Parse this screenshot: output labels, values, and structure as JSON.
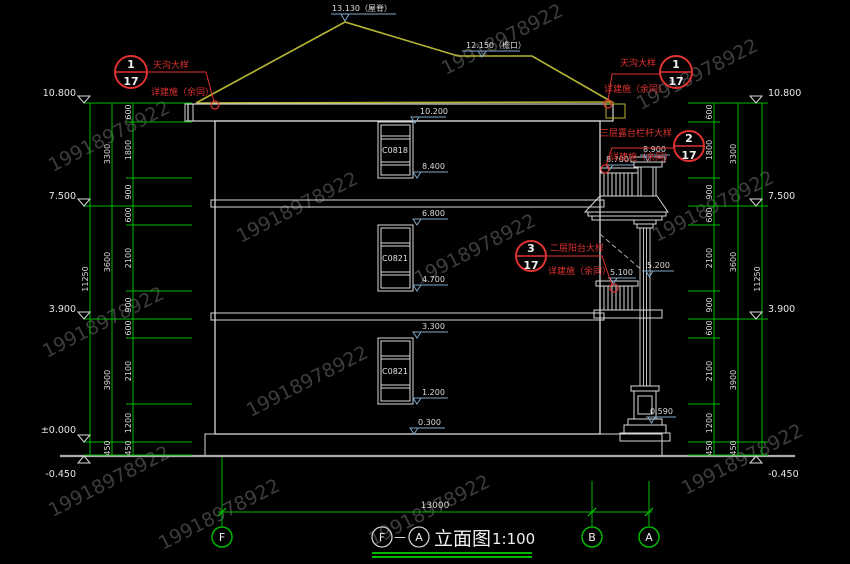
{
  "watermark": "19918978922",
  "title": {
    "axis_from": "F",
    "separator": "—",
    "axis_to": "A",
    "name": "立面图",
    "scale": "1:100"
  },
  "top_marks": {
    "ridge": "13.130（屋脊）",
    "eave": "12.150（檐口）"
  },
  "elevations": {
    "left": [
      "10.800",
      "7.500",
      "3.900",
      "±0.000",
      "-0.450"
    ],
    "right": [
      "10.800",
      "7.500",
      "3.900",
      "-0.450"
    ]
  },
  "dimensions": {
    "inner": [
      "600",
      "1800",
      "900",
      "600",
      "2100",
      "900",
      "600",
      "2100",
      "1200",
      "450"
    ],
    "story": [
      "3300",
      "3600",
      "3900",
      "450"
    ],
    "total": "11250",
    "bottom_total": "13000"
  },
  "windows": [
    {
      "label": "C0818",
      "head": "10.200",
      "sill": "8.400"
    },
    {
      "label": "C0821",
      "head": "6.800",
      "sill": "4.700"
    },
    {
      "label": "C0821",
      "head": "3.300",
      "sill": "1.200"
    }
  ],
  "side_marks": {
    "terrace_railing": "8.700",
    "terrace_canopy": "8.900",
    "balcony_railing": "5.100",
    "balcony_column": "5.200",
    "column_base": "0.590",
    "plinth": "0.300"
  },
  "callouts": [
    {
      "number": "1",
      "sheet": "17",
      "title": "天沟大样",
      "note": "详建施（余同）"
    },
    {
      "number": "1",
      "sheet": "17",
      "title": "天沟大样",
      "note": "详建施（余同）"
    },
    {
      "number": "2",
      "sheet": "17",
      "title": "三层露台栏杆大样",
      "note": "详建施（余同）"
    },
    {
      "number": "3",
      "sheet": "17",
      "title": "二层阳台大样",
      "note": "详建施（余同）"
    }
  ],
  "axes": [
    "F",
    "B",
    "A"
  ],
  "colors": {
    "background": "#000000",
    "dimension_green": "#00b800",
    "drawing_white": "#d8d8d8",
    "roof_yellow": "#b5b533",
    "annotation_red": "#e03232",
    "marker_blue": "#7fa8c8"
  }
}
